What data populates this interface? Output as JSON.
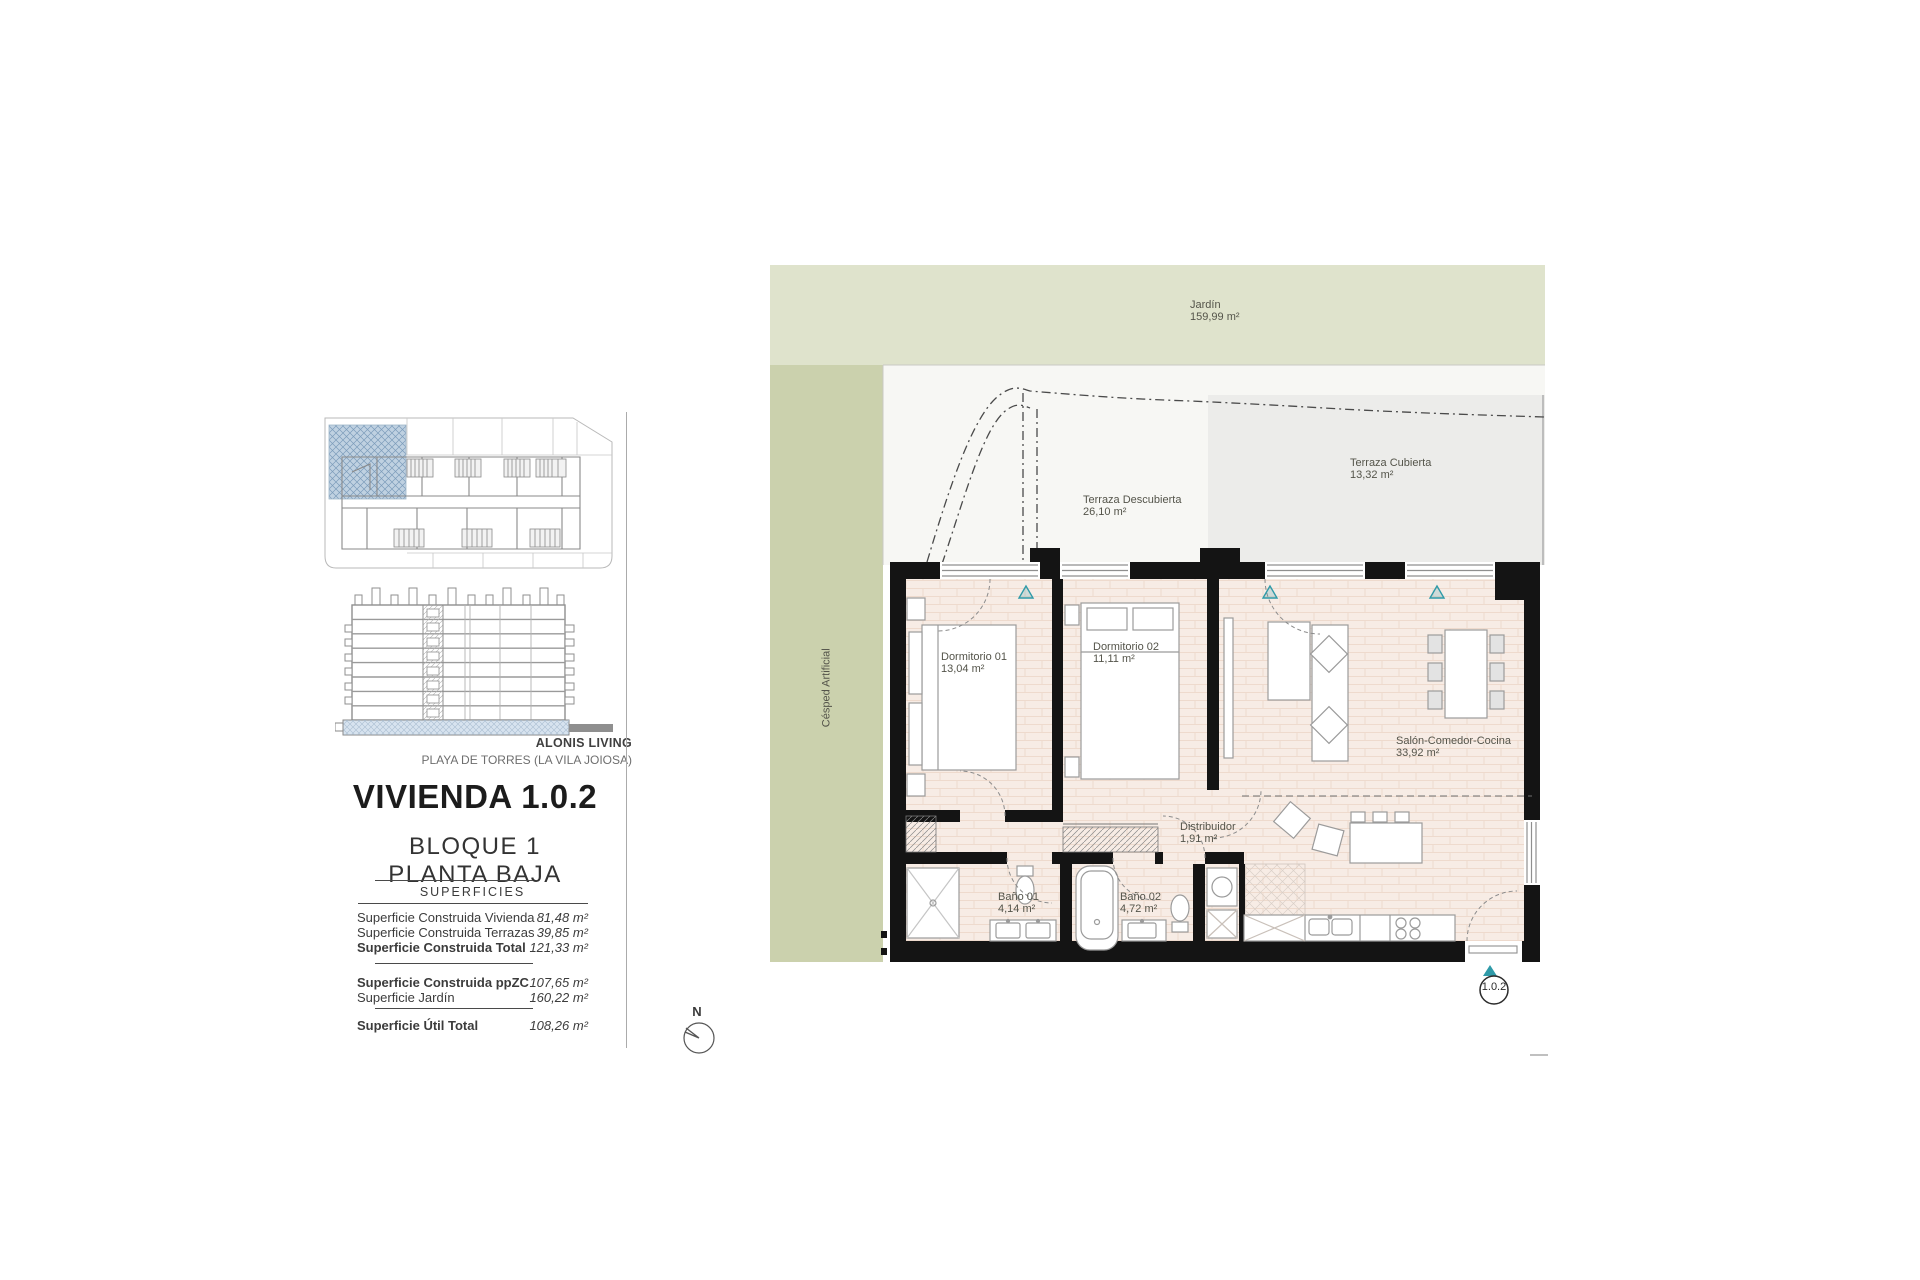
{
  "branding": {
    "project": "ALONIS LIVING",
    "location": "PLAYA DE TORRES (LA VILA JOIOSA)"
  },
  "unit": {
    "title": "VIVIENDA 1.0.2",
    "block": "BLOQUE 1",
    "floor": "PLANTA BAJA",
    "unit_code": "1.0.2"
  },
  "surfaces": {
    "heading": "SUPERFICIES",
    "rows": [
      {
        "label": "Superficie Construida Vivienda",
        "value": "81,48 m²",
        "bold": false
      },
      {
        "label": "Superficie Construida Terrazas",
        "value": "39,85 m²",
        "bold": false
      },
      {
        "label": "Superficie Construida Total",
        "value": "121,33 m²",
        "bold": true
      },
      {
        "label": "Superficie Construida ppZC",
        "value": "107,65 m²",
        "bold": true
      },
      {
        "label": "Superficie Jardín",
        "value": "160,22 m²",
        "bold": false
      },
      {
        "label": "Superficie Útil Total",
        "value": "108,26 m²",
        "bold": true
      }
    ]
  },
  "plan": {
    "compass_label": "N",
    "areas": {
      "jardin": {
        "name": "Jardín",
        "area": "159,99 m²"
      },
      "terraza_descubierta": {
        "name": "Terraza Descubierta",
        "area": "26,10 m²"
      },
      "terraza_cubierta": {
        "name": "Terraza Cubierta",
        "area": "13,32 m²"
      },
      "cesped": {
        "name": "Césped Artificial"
      },
      "dormitorio_01": {
        "name": "Dormitorio 01",
        "area": "13,04 m²"
      },
      "dormitorio_02": {
        "name": "Dormitorio 02",
        "area": "11,11 m²"
      },
      "salon": {
        "name": "Salón-Comedor-Cocina",
        "area": "33,92 m²"
      },
      "distribuidor": {
        "name": "Distribuidor",
        "area": "1,91 m²"
      },
      "bano_01": {
        "name": "Baño 01",
        "area": "4,14 m²"
      },
      "bano_02": {
        "name": "Baño 02",
        "area": "4,72 m²"
      }
    }
  },
  "colors": {
    "garden_top": "#dfe3cc",
    "garden_side": "#cbd1ad",
    "terrace_covered": "#ececea",
    "floor_brick": "#f7ece5",
    "wall": "#141414",
    "accent_teal": "#2f9aa8",
    "site_highlight": "#bccfdf"
  }
}
